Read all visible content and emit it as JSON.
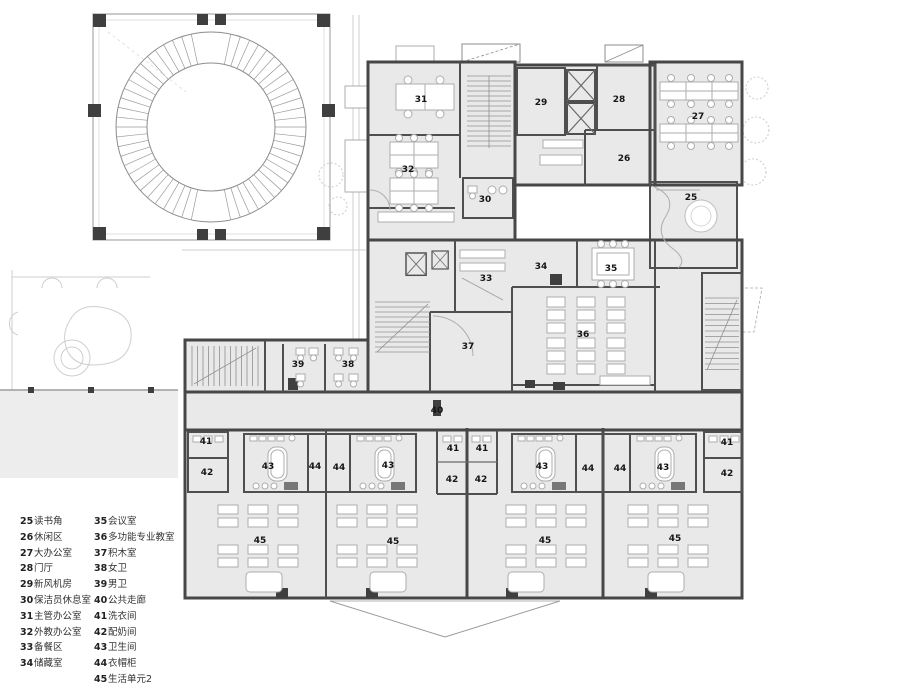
{
  "plan": {
    "labels": [
      "31",
      "29",
      "28",
      "27",
      "32",
      "26",
      "30",
      "25",
      "33",
      "34",
      "35",
      "36",
      "37",
      "39",
      "38",
      "40",
      "41",
      "42",
      "43",
      "44",
      "44",
      "43",
      "41",
      "41",
      "42",
      "42",
      "43",
      "44",
      "44",
      "43",
      "41",
      "42",
      "45",
      "45",
      "45",
      "45"
    ]
  },
  "legend": {
    "items": [
      {
        "num": "25",
        "label": "读书角"
      },
      {
        "num": "26",
        "label": "休闲区"
      },
      {
        "num": "27",
        "label": "大办公室"
      },
      {
        "num": "28",
        "label": "门厅"
      },
      {
        "num": "29",
        "label": "新风机房"
      },
      {
        "num": "30",
        "label": "保洁员休息室"
      },
      {
        "num": "31",
        "label": "主管办公室"
      },
      {
        "num": "32",
        "label": "外教办公室"
      },
      {
        "num": "33",
        "label": "备餐区"
      },
      {
        "num": "34",
        "label": "储藏室"
      },
      {
        "num": "35",
        "label": "会议室"
      },
      {
        "num": "36",
        "label": "多功能专业教室"
      },
      {
        "num": "37",
        "label": "积木室"
      },
      {
        "num": "38",
        "label": "女卫"
      },
      {
        "num": "39",
        "label": "男卫"
      },
      {
        "num": "40",
        "label": "公共走廊"
      },
      {
        "num": "41",
        "label": "洗衣间"
      },
      {
        "num": "42",
        "label": "配奶间"
      },
      {
        "num": "43",
        "label": "卫生间"
      },
      {
        "num": "44",
        "label": "衣帽柜"
      },
      {
        "num": "45",
        "label": "生活单元2"
      }
    ]
  },
  "colors": {
    "room_fill": "#e9e9e9",
    "wall": "#474747",
    "label": "#161616"
  }
}
